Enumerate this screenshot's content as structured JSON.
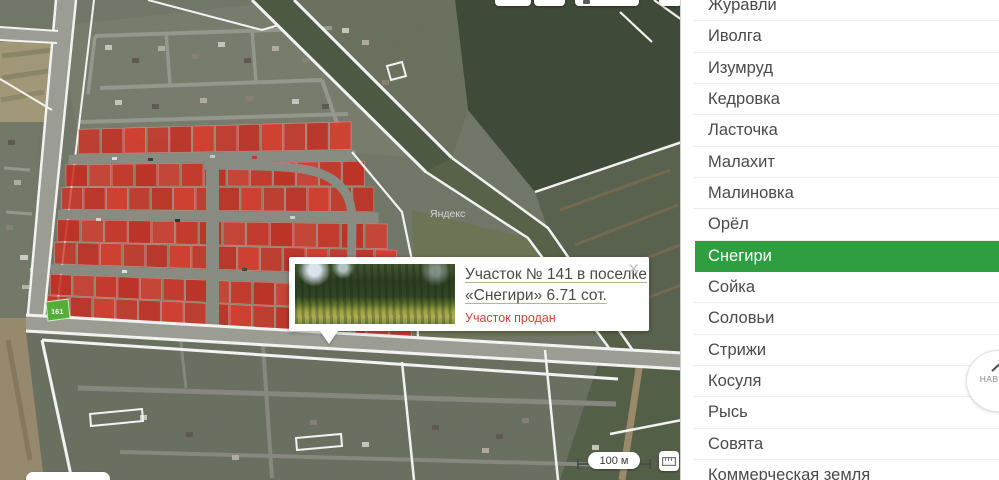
{
  "sidebar": {
    "items": [
      {
        "label": "Журавли",
        "selected": false
      },
      {
        "label": "Иволга",
        "selected": false
      },
      {
        "label": "Изумруд",
        "selected": false
      },
      {
        "label": "Кедровка",
        "selected": false
      },
      {
        "label": "Ласточка",
        "selected": false
      },
      {
        "label": "Малахит",
        "selected": false
      },
      {
        "label": "Малиновка",
        "selected": false
      },
      {
        "label": "Орёл",
        "selected": false
      },
      {
        "label": "Снегири",
        "selected": true
      },
      {
        "label": "Сойка",
        "selected": false
      },
      {
        "label": "Соловьи",
        "selected": false
      },
      {
        "label": "Стрижи",
        "selected": false
      },
      {
        "label": "Косуля",
        "selected": false
      },
      {
        "label": "Рысь",
        "selected": false
      },
      {
        "label": "Совята",
        "selected": false
      },
      {
        "label": "Коммерческая земля",
        "selected": false
      }
    ]
  },
  "popup": {
    "title": "Участок № 141 в поселке «Снегири» 6.71 сот.",
    "status": "Участок продан",
    "close_glyph": "✕"
  },
  "map": {
    "scale_label": "100 м",
    "available_plot_label": "161",
    "watermark": "Яндекс"
  },
  "back_to_top": {
    "label": "НАВЕРХ"
  },
  "colors": {
    "selected_green": "#2f9e41",
    "sold_red": "#e02a1e",
    "status_red": "#cc4434",
    "available_green": "#54b538"
  }
}
